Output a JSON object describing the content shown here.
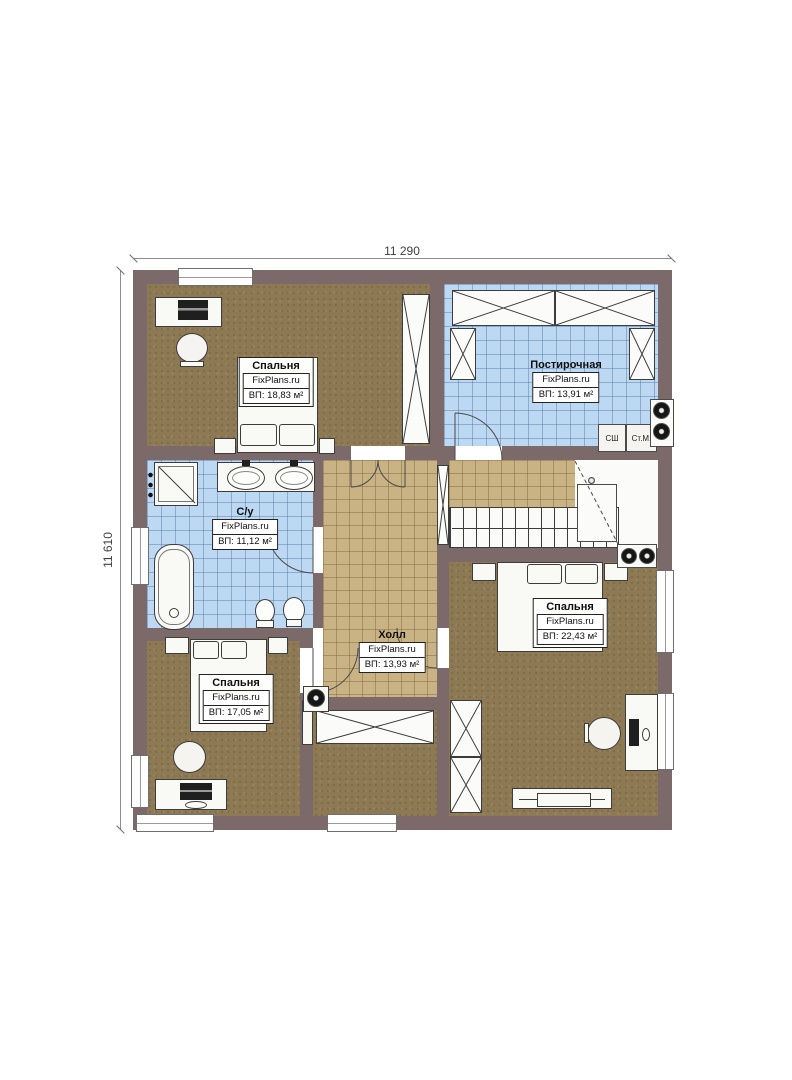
{
  "dimensions": {
    "top": "11 290",
    "left": "11 610"
  },
  "rooms": {
    "bedroom_tl": {
      "name": "Спальня",
      "brand": "FixPlans.ru",
      "area": "ВП: 18,83 м²"
    },
    "laundry": {
      "name": "Постирочная",
      "brand": "FixPlans.ru",
      "area": "ВП: 13,91 м²"
    },
    "bathroom": {
      "name": "С/у",
      "brand": "FixPlans.ru",
      "area": "ВП: 11,12 м²"
    },
    "hall": {
      "name": "Холл",
      "brand": "FixPlans.ru",
      "area": "ВП: 13,93 м²"
    },
    "bedroom_right": {
      "name": "Спальня",
      "brand": "FixPlans.ru",
      "area": "ВП: 22,43 м²"
    },
    "bedroom_bl": {
      "name": "Спальня",
      "brand": "FixPlans.ru",
      "area": "ВП: 17,05 м²"
    }
  },
  "appliances": {
    "dryer_cabinet": "СШ",
    "washing_machine": "Ст.М."
  },
  "colors": {
    "wall": "#7c6a6a",
    "wood_floor": "#8d7953",
    "tile_blue": "#bdd8f2",
    "tile_tan": "#c9b384",
    "fixture_white": "#f9f9f6"
  }
}
